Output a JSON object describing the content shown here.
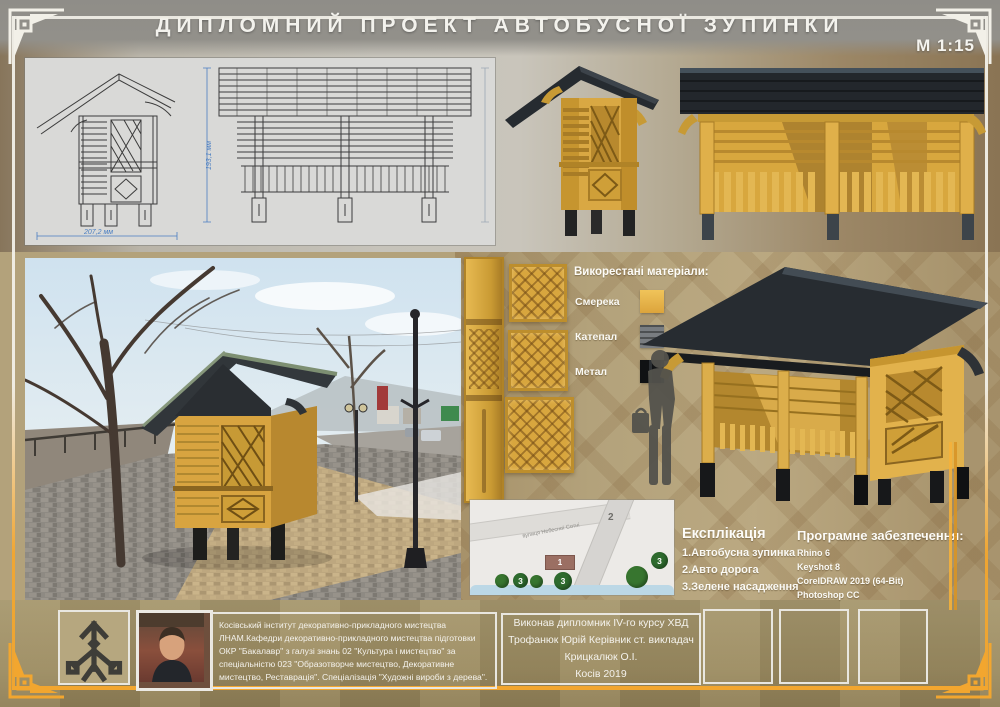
{
  "header": {
    "title": "ДИПЛОМНИЙ ПРОЕКТ АВТОБУСНОЇ ЗУПИНКИ",
    "scale": "М 1:15"
  },
  "drawings": {
    "dim_width": "207,2 мм",
    "dim_height": "193,1 мм"
  },
  "materials": {
    "heading": "Викорестані матеріали:",
    "items": [
      {
        "name": "Смерека",
        "color": "#e6b547"
      },
      {
        "name": "Катепал",
        "color": "#72767a"
      },
      {
        "name": "Метал",
        "color": "#17191c"
      }
    ]
  },
  "site_plan": {
    "street_label": "вулиця Небесної Сотні",
    "markers": {
      "stop": "1",
      "road": "2",
      "green": "3"
    }
  },
  "explication": {
    "heading": "Експлікація",
    "items": [
      "1.Автобусна зупинка",
      "2.Авто дорога",
      "3.Зелене насадження"
    ]
  },
  "software": {
    "heading": "Програмне забезпечення:",
    "items": [
      "Rhino 6",
      "Keyshot 8",
      "CorelDRAW 2019 (64-Bit)",
      "Photoshop CC"
    ]
  },
  "footer": {
    "institute": "Косівський інститут декоративно-прикладного мистецтва ЛНАМ.Кафедри декоративно-прикладного мистецтва підготовки ОКР \"Бакалавр\" з галузі знань 02 \"Культура і мистецтво\" за спеціальністю 023 \"Образотворче мистецтво, Декоративне мистецтво, Реставрація\". Спеціалізація \"Художні вироби з дерева\".",
    "author_lines": [
      "Виконав дипломник IV-го курсу ХВД",
      "Трофанюк Юрій Керівник ст. викладач",
      "Крицкалюк О.І.",
      "Косів 2019"
    ]
  },
  "colors": {
    "accent_gold": "#f2a62f",
    "wood_yellow": "#d9a843",
    "roof_dark": "#24282c",
    "background_tan": "#b3a27b",
    "panel_gray": "#d9d9d7",
    "marker_green": "#2f6f33",
    "dimension_blue": "#4a7ec2"
  }
}
